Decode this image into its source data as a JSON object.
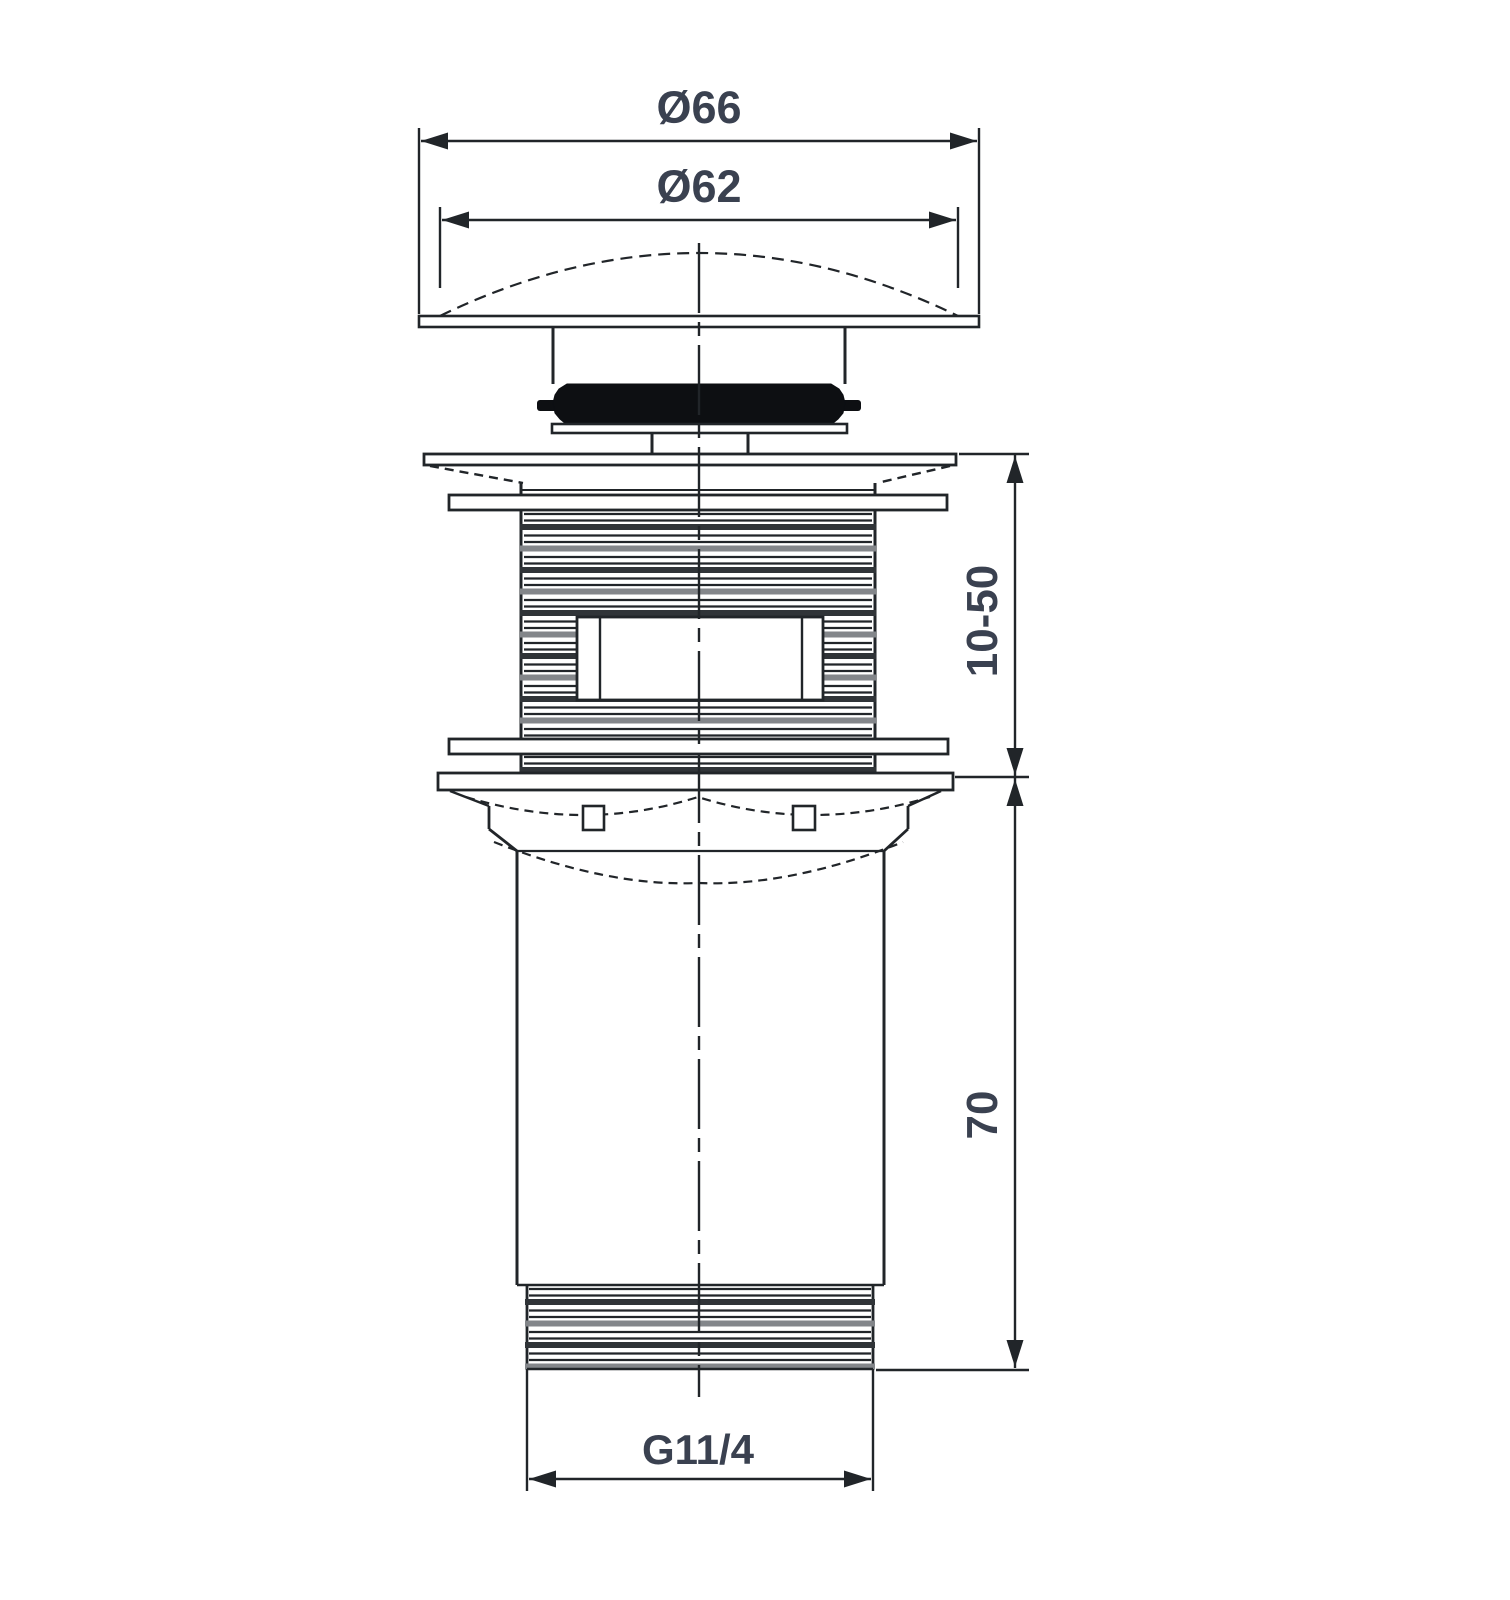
{
  "colors": {
    "background": "#ffffff",
    "line": "#212529",
    "thread_band_dark": "#303438",
    "thread_band_gray": "#83868a",
    "label_text": "#3a4150",
    "gasket_fill": "#0d0f12"
  },
  "labels": {
    "cap_outer_diameter": "Ø66",
    "cap_dome_diameter": "Ø62",
    "clamping_range": "10-50",
    "tail_length": "70",
    "thread_size": "G11/4"
  }
}
